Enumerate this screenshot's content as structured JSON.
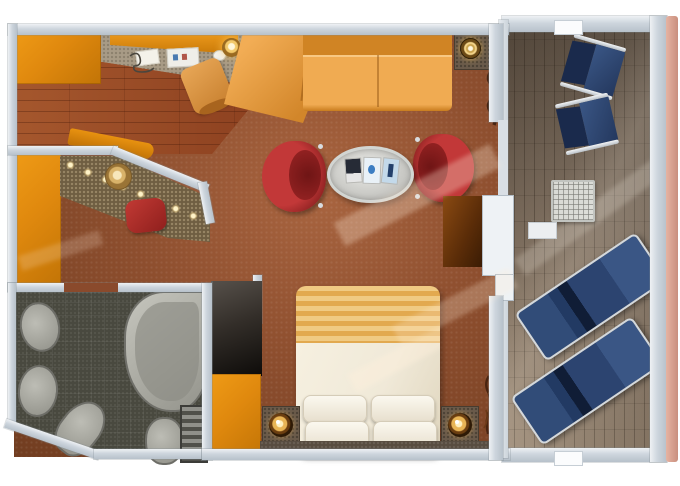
{
  "meta": {
    "kind": "cruise-ship-stateroom-floor-plan",
    "width_px": 680,
    "height_px": 486
  },
  "colors": {
    "background": "#ffffff",
    "wall": "#c4cdd5",
    "carpet": "#8d4e2e",
    "carpet_shadow": "#713d20",
    "carpet_glow": "#a96540",
    "desk_surface": "#a89b86",
    "wood": "#9c5028",
    "orange": "#e0890e",
    "sofa": "#f0ab52",
    "sofa_shadow": "#d08424",
    "armchair_red": "#b23131",
    "armchair_red_dark": "#801b1b",
    "table_silver": "#d6d6d2",
    "counter_speckle": "#6f5e42",
    "spotlight_gold": "#ffe9ad",
    "lamp_gold": "#f2c96a",
    "bath_tile": "#49493f",
    "bath_fixture": "#8f8f87",
    "wardrobe_dark": "#1c1916",
    "cabinet_brown": "#6e3a10",
    "bed_duvet": "#f0e9d8",
    "bed_stripe": "#e2a94f",
    "pillow_white": "#f7f3e8",
    "nightstand": "#6a5b4b",
    "deck_wood": "#7d6e5f",
    "lounger_navy": "#2c4470",
    "frame_silver": "#d3d8dc",
    "railing_salmon": "#dca493",
    "balcony_table": "#dededa"
  },
  "items": {
    "floor-plan": "cruise-suite-floor-plan",
    "balcony": "private-balcony",
    "lounger": "sun-lounger",
    "deck-chair": "deck-chair",
    "balcony-table": "balcony-side-table",
    "railing": "balcony-railing",
    "sofa": "sectional-sofa",
    "armchair": "red-armchair",
    "coffee-table": "oval-coffee-table",
    "bed": "king-bed",
    "nightstand": "nightstand-with-lamp",
    "wardrobe": "wardrobe",
    "bathroom": "bathroom",
    "bathtub": "bathtub",
    "vanity": "vanity-counter-with-spotlights",
    "desk": "writing-desk"
  }
}
